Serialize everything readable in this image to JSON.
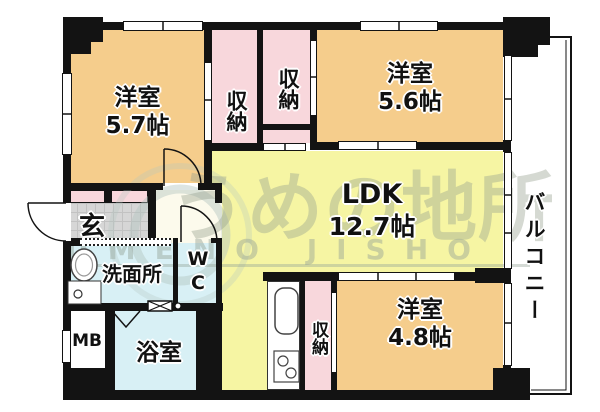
{
  "floorplan_title": "apartment-floorplan",
  "rooms": {
    "western_room_top_left": {
      "name": "洋室",
      "size": "5.7帖"
    },
    "western_room_top_right": {
      "name": "洋室",
      "size": "5.6帖"
    },
    "western_room_bottom_right": {
      "name": "洋室",
      "size": "4.8帖"
    },
    "ldk": {
      "name": "LDK",
      "size": "12.7帖"
    },
    "closet_top_left": {
      "name": "収納"
    },
    "closet_top_right": {
      "name": "収納"
    },
    "closet_bottom": {
      "name": "収納"
    },
    "entrance": {
      "name": "玄"
    },
    "washroom": {
      "name": "洗面所"
    },
    "toilet": {
      "line1": "W",
      "line2": "C"
    },
    "bathroom": {
      "name": "浴室"
    },
    "meter_box": {
      "name": "MB"
    },
    "balcony": {
      "name": "バルコニー"
    }
  },
  "watermark": {
    "kanji": "うめの地所",
    "romaji": "UMENO JISHO"
  },
  "colors": {
    "wall": "#131313",
    "western_room": "#F5CD8C",
    "ldk": "#F6F5A3",
    "closet": "#F8D7DC",
    "wet_area": "#D8F0F5",
    "entrance_floor": "#D6D6D6",
    "watermark": "#96A296"
  }
}
